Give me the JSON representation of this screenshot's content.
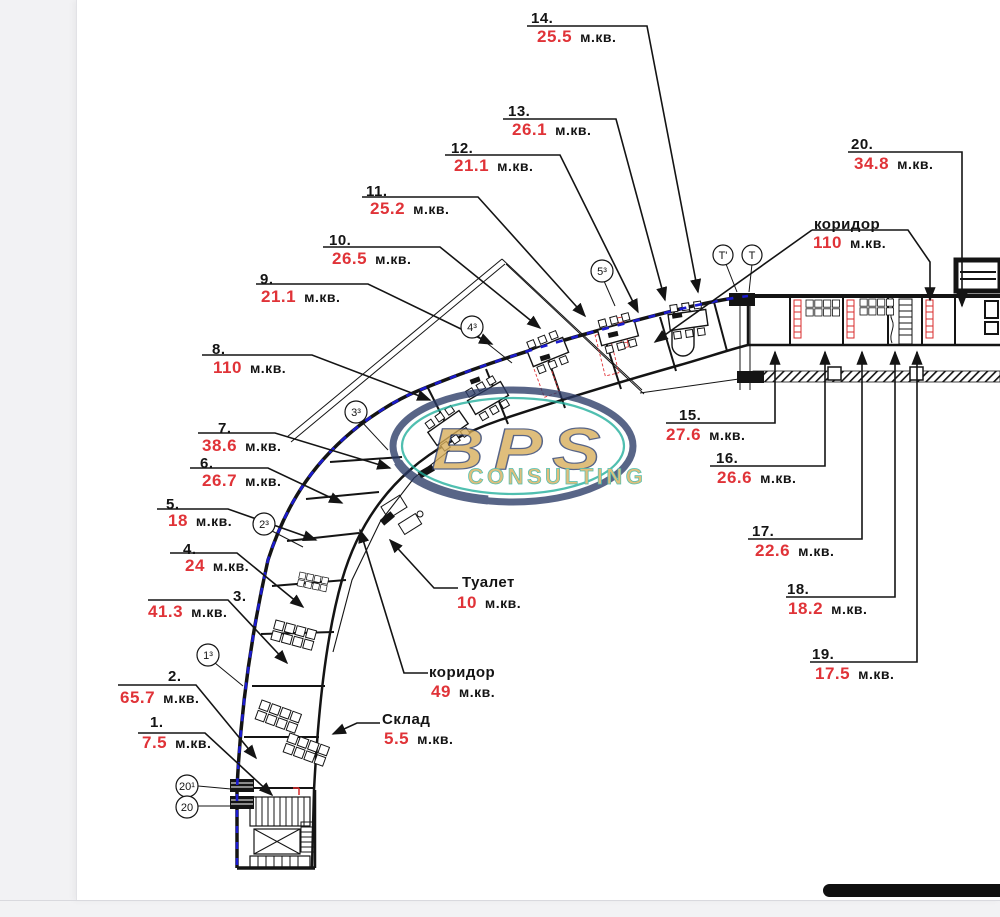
{
  "units": "м.кв.",
  "colors": {
    "area_red": "#e03338",
    "ink": "#141414",
    "blue_dash": "#1b1bcf",
    "wm_gold": "#d7ad58",
    "wm_navy": "#2a3a66",
    "wm_teal": "#1fae9b"
  },
  "rooms": [
    {
      "num": "1.",
      "area": "7.5"
    },
    {
      "num": "2.",
      "area": "65.7"
    },
    {
      "num": "3.",
      "area": "41.3"
    },
    {
      "num": "4.",
      "area": "24"
    },
    {
      "num": "5.",
      "area": "18"
    },
    {
      "num": "6.",
      "area": "26.7"
    },
    {
      "num": "7.",
      "area": "38.6"
    },
    {
      "num": "8.",
      "area": "110"
    },
    {
      "num": "9.",
      "area": "21.1"
    },
    {
      "num": "10.",
      "area": "26.5"
    },
    {
      "num": "11.",
      "area": "25.2"
    },
    {
      "num": "12.",
      "area": "21.1"
    },
    {
      "num": "13.",
      "area": "26.1"
    },
    {
      "num": "14.",
      "area": "25.5"
    },
    {
      "num": "15.",
      "area": "27.6"
    },
    {
      "num": "16.",
      "area": "26.6"
    },
    {
      "num": "17.",
      "area": "22.6"
    },
    {
      "num": "18.",
      "area": "18.2"
    },
    {
      "num": "19.",
      "area": "17.5"
    },
    {
      "num": "20.",
      "area": "34.8"
    }
  ],
  "named": [
    {
      "name": "коридор",
      "area": "110"
    },
    {
      "name": "Туалет",
      "area": "10"
    },
    {
      "name": "коридор",
      "area": "49"
    },
    {
      "name": "Склад",
      "area": "5.5"
    }
  ],
  "markers": [
    "5³",
    "4³",
    "3³",
    "2³",
    "1³",
    "20¹",
    "20",
    "Т'",
    "Т"
  ],
  "watermark": {
    "brand": "BPS",
    "sub": "CONSULTING"
  }
}
